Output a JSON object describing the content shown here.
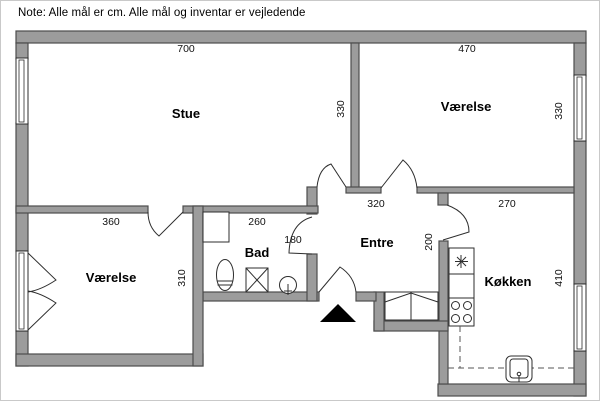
{
  "note": "Note: Alle mål er cm. Alle mål og inventar er vejledende",
  "colors": {
    "wall_fill": "#9c9c9c",
    "wall_stroke": "#4d4d4d",
    "line": "#2e2e2e",
    "background": "#ffffff",
    "marker": "#000000"
  },
  "rooms": [
    {
      "id": "stue",
      "label": "Stue",
      "x": 185,
      "y": 117
    },
    {
      "id": "vaerelse-top",
      "label": "Værelse",
      "x": 465,
      "y": 110
    },
    {
      "id": "vaerelse-left",
      "label": "Værelse",
      "x": 110,
      "y": 281
    },
    {
      "id": "bad",
      "label": "Bad",
      "x": 256,
      "y": 256
    },
    {
      "id": "entre",
      "label": "Entre",
      "x": 376,
      "y": 246
    },
    {
      "id": "koekken",
      "label": "Køkken",
      "x": 507,
      "y": 285
    }
  ],
  "dimensions": [
    {
      "text": "700",
      "x": 185,
      "y": 51,
      "rot": false
    },
    {
      "text": "470",
      "x": 466,
      "y": 51,
      "rot": false
    },
    {
      "text": "330",
      "x": 343,
      "y": 108,
      "rot": true
    },
    {
      "text": "330",
      "x": 561,
      "y": 110,
      "rot": true
    },
    {
      "text": "360",
      "x": 110,
      "y": 224,
      "rot": false
    },
    {
      "text": "260",
      "x": 256,
      "y": 224,
      "rot": false
    },
    {
      "text": "320",
      "x": 375,
      "y": 206,
      "rot": false
    },
    {
      "text": "270",
      "x": 506,
      "y": 206,
      "rot": false
    },
    {
      "text": "180",
      "x": 292,
      "y": 242,
      "rot": false
    },
    {
      "text": "310",
      "x": 184,
      "y": 277,
      "rot": true
    },
    {
      "text": "200",
      "x": 431,
      "y": 241,
      "rot": true
    },
    {
      "text": "410",
      "x": 561,
      "y": 277,
      "rot": true
    }
  ],
  "plan": {
    "canvas": {
      "w": 600,
      "h": 401
    },
    "walls": [
      {
        "n": "wall-top",
        "r": [
          15,
          30,
          570,
          12
        ]
      },
      {
        "n": "wall-left-upper",
        "r": [
          15,
          42,
          12,
          16
        ]
      },
      {
        "n": "wall-left-middle",
        "r": [
          15,
          122,
          12,
          128
        ]
      },
      {
        "n": "wall-left-lower",
        "r": [
          15,
          330,
          12,
          35
        ]
      },
      {
        "n": "wall-bottom-left",
        "r": [
          15,
          353,
          187,
          12
        ]
      },
      {
        "n": "wall-right-upper",
        "r": [
          573,
          42,
          12,
          33
        ]
      },
      {
        "n": "wall-right-middle",
        "r": [
          573,
          140,
          12,
          143
        ]
      },
      {
        "n": "wall-right-lower",
        "r": [
          573,
          350,
          12,
          45
        ]
      },
      {
        "n": "wall-bottom-kitchen",
        "r": [
          437,
          383,
          148,
          12
        ]
      },
      {
        "n": "wall-divider-stue-vaerelse",
        "r": [
          350,
          42,
          8,
          145
        ]
      },
      {
        "n": "wall-entre-top-stub",
        "r": [
          345,
          186,
          35,
          6
        ]
      },
      {
        "n": "wall-entre-top-right",
        "r": [
          416,
          186,
          157,
          6
        ]
      },
      {
        "n": "wall-kitchen-door-stub",
        "r": [
          437,
          192,
          10,
          12
        ]
      },
      {
        "n": "wall-kitchen-left",
        "r": [
          438,
          240,
          9,
          143
        ]
      },
      {
        "n": "wall-step-horizontal",
        "r": [
          373,
          320,
          74,
          10
        ]
      },
      {
        "n": "wall-step-vertical",
        "r": [
          373,
          291,
          10,
          39
        ]
      },
      {
        "n": "wall-entrance-right",
        "r": [
          355,
          291,
          20,
          9
        ]
      },
      {
        "n": "wall-bad-bottom",
        "r": [
          202,
          291,
          116,
          9
        ]
      },
      {
        "n": "wall-bad-right-upper",
        "r": [
          306,
          186,
          10,
          27
        ]
      },
      {
        "n": "wall-bad-right-lower",
        "r": [
          306,
          253,
          10,
          47
        ]
      },
      {
        "n": "wall-stue-bottom-a",
        "r": [
          15,
          205,
          132,
          7
        ]
      },
      {
        "n": "wall-stue-bottom-b",
        "r": [
          182,
          205,
          135,
          7
        ]
      },
      {
        "n": "wall-vaerelse-left-right",
        "r": [
          192,
          205,
          10,
          160
        ]
      }
    ],
    "windows": [
      {
        "n": "window-stue-left",
        "outer": [
          15,
          57,
          12,
          66
        ],
        "inner": [
          18,
          59,
          5,
          62
        ]
      },
      {
        "n": "window-vaerelse-left",
        "outer": [
          15,
          250,
          12,
          80
        ],
        "inner": [
          18,
          252,
          5,
          76
        ],
        "leaves": [
          "M27,252 L55,279 Q40,289 27,291",
          "M27,329 L55,302 Q40,292 27,290"
        ]
      },
      {
        "n": "window-vaerelse-right",
        "outer": [
          573,
          74,
          12,
          66
        ],
        "inner": [
          576,
          76,
          5,
          62
        ]
      },
      {
        "n": "window-koekken-right",
        "outer": [
          573,
          283,
          12,
          67
        ],
        "inner": [
          576,
          285,
          5,
          63
        ]
      }
    ],
    "doors": [
      {
        "n": "door-stue",
        "d": "M316,186 Q318,167 330,163 L345,186"
      },
      {
        "n": "door-vaerelse-top",
        "d": "M380,187 L402,159 Q414,169 416,187"
      },
      {
        "n": "door-vaerelse-left",
        "d": "M147,211 Q147,226 158,235 L182,211"
      },
      {
        "n": "door-bad",
        "d": "M311,216 Q289,222 288,252 L311,253"
      },
      {
        "n": "door-entrance",
        "d": "M318,291 L339,266 Q353,275 355,291"
      },
      {
        "n": "door-koekken",
        "d": "M446,204 Q468,212 468,231 L442,239"
      }
    ],
    "fixtures": [
      {
        "n": "washing-machine",
        "p": [
          {
            "t": "rect",
            "a": [
              202,
              211,
              26,
              30
            ]
          }
        ]
      },
      {
        "n": "toilet",
        "p": [
          {
            "t": "ellipse",
            "a": [
              224,
              274,
              8.5,
              15.5
            ]
          },
          {
            "t": "line",
            "a": [
              216,
              280,
              232,
              280
            ]
          },
          {
            "t": "line",
            "a": [
              216.5,
              284,
              231.5,
              284
            ]
          }
        ]
      },
      {
        "n": "shower",
        "p": [
          {
            "t": "rect",
            "a": [
              245,
              267,
              22,
              24
            ]
          },
          {
            "t": "line",
            "a": [
              245,
              267,
              267,
              291
            ]
          },
          {
            "t": "line",
            "a": [
              267,
              267,
              245,
              291
            ]
          }
        ]
      },
      {
        "n": "sink-bad",
        "p": [
          {
            "t": "circle",
            "a": [
              287,
              284,
              8.5
            ]
          },
          {
            "t": "line",
            "a": [
              287,
              283,
              287,
              294
            ]
          },
          {
            "t": "line",
            "a": [
              283,
              290,
              291,
              290
            ]
          }
        ]
      },
      {
        "n": "fridge",
        "p": [
          {
            "t": "rect",
            "a": [
              448,
              247,
              25,
              26
            ]
          },
          {
            "t": "line",
            "a": [
              460,
              254,
              460,
              267
            ]
          },
          {
            "t": "line",
            "a": [
              454,
              260.5,
              467,
              260.5
            ]
          },
          {
            "t": "line",
            "a": [
              456,
              256,
              465,
              265
            ]
          },
          {
            "t": "line",
            "a": [
              465,
              256,
              456,
              265
            ]
          }
        ]
      },
      {
        "n": "counter",
        "p": [
          {
            "t": "rect",
            "a": [
              448,
              273,
              25,
              24
            ]
          }
        ]
      },
      {
        "n": "stove",
        "p": [
          {
            "t": "rect",
            "a": [
              448,
              297,
              25,
              28
            ]
          },
          {
            "t": "circle",
            "a": [
              454.5,
              304.5,
              4
            ]
          },
          {
            "t": "circle",
            "a": [
              466.5,
              304.5,
              4
            ]
          },
          {
            "t": "circle",
            "a": [
              454.5,
              317.5,
              4
            ]
          },
          {
            "t": "circle",
            "a": [
              466.5,
              317.5,
              4
            ]
          }
        ]
      },
      {
        "n": "counter-outline-dashed",
        "dash": true,
        "p": [
          {
            "t": "path",
            "d": "M459,325 L459,367"
          },
          {
            "t": "path",
            "d": "M447,367 L573,367"
          }
        ]
      },
      {
        "n": "sink-koekken",
        "p": [
          {
            "t": "rect",
            "a": [
              505,
              355,
              26,
              26
            ],
            "rx": 5
          },
          {
            "t": "rect",
            "a": [
              509,
              358,
              18,
              19
            ],
            "rx": 3
          },
          {
            "t": "circle",
            "a": [
              518,
              373,
              1.8
            ]
          },
          {
            "t": "line",
            "a": [
              518,
              374,
              518,
              381
            ]
          },
          {
            "t": "line",
            "a": [
              514,
              381,
              522,
              381
            ]
          }
        ]
      },
      {
        "n": "wardrobe",
        "p": [
          {
            "t": "rect",
            "a": [
              384,
              291,
              53,
              28
            ]
          },
          {
            "t": "line",
            "a": [
              410,
              291,
              410,
              319
            ]
          },
          {
            "t": "path",
            "d": "M384,301 L410,292 L437,301"
          }
        ]
      }
    ],
    "entrance_marker": {
      "n": "entrance-arrow",
      "points": "337,303 319,321 355,321"
    }
  }
}
